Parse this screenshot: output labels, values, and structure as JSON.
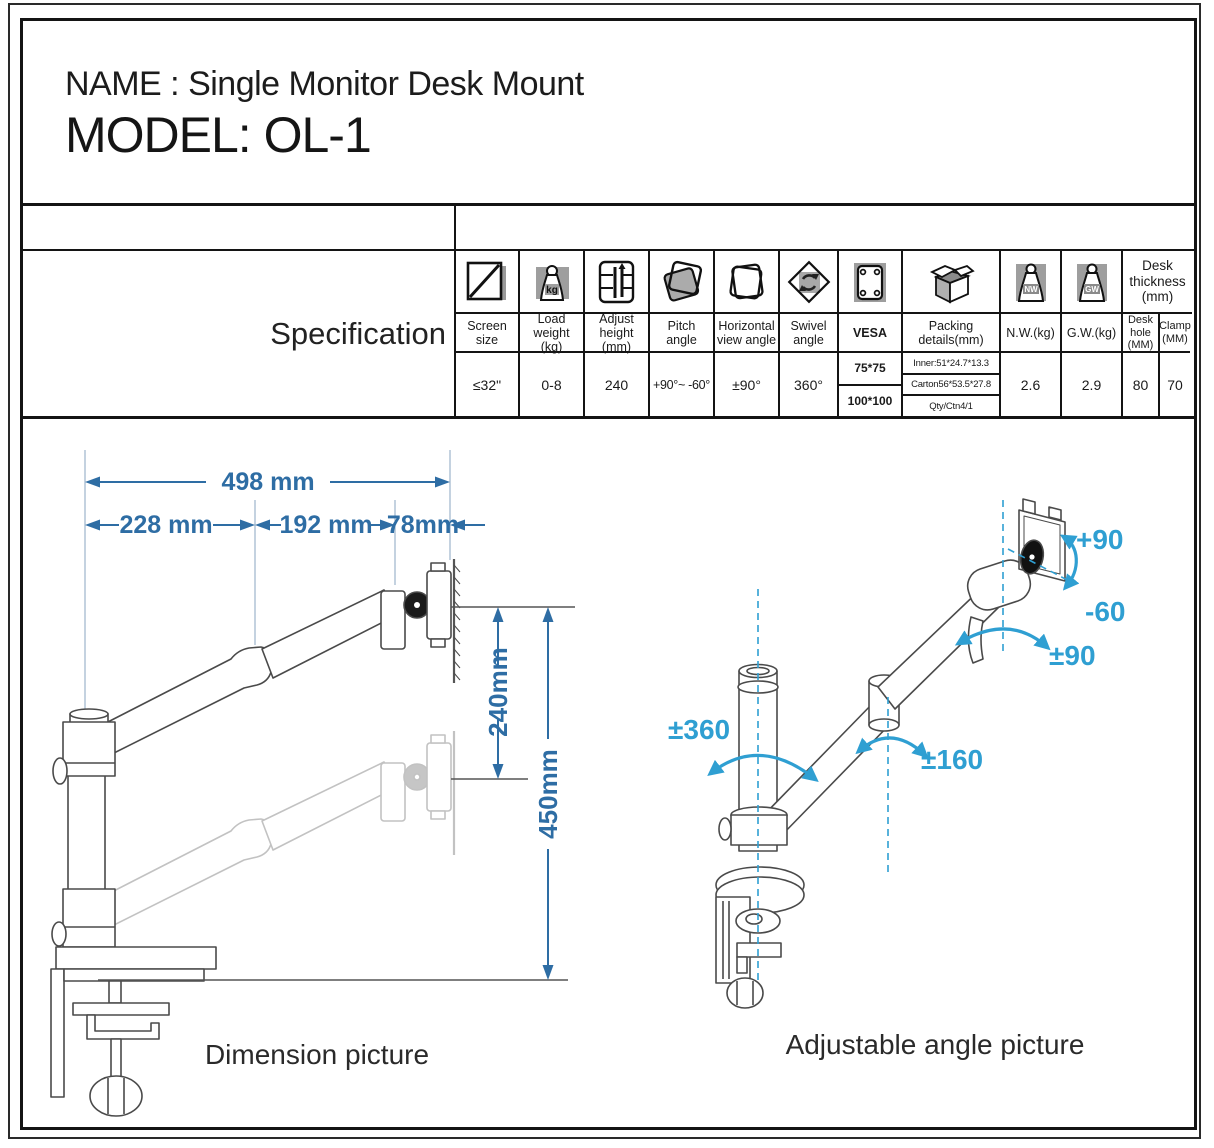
{
  "header": {
    "name_line": "NAME : Single Monitor Desk Mount",
    "model_line": "MODEL: OL-1"
  },
  "spec": {
    "section_label": "Specification",
    "icon_text": {
      "kg": "kg",
      "nw": "NW",
      "gw": "GW"
    },
    "desk_thickness_header": "Desk thickness (mm)",
    "columns": [
      {
        "icon": "screen-size-icon",
        "label": "Screen size",
        "value": "≤32\""
      },
      {
        "icon": "load-weight-icon",
        "label": "Load weight (kg)",
        "value": "0-8"
      },
      {
        "icon": "adjust-height-icon",
        "label": "Adjust height (mm)",
        "value": "240"
      },
      {
        "icon": "pitch-angle-icon",
        "label": "Pitch angle",
        "value": "+90°~ -60°"
      },
      {
        "icon": "horizontal-view-icon",
        "label": "Horizontal view angle",
        "value": "±90°"
      },
      {
        "icon": "swivel-angle-icon",
        "label": "Swivel angle",
        "value": "360°"
      },
      {
        "icon": "vesa-icon",
        "label": "VESA",
        "values": [
          "75*75",
          "100*100"
        ]
      },
      {
        "icon": "packing-box-icon",
        "label": "Packing details(mm)",
        "values": [
          "Inner:51*24.7*13.3",
          "Carton56*53.5*27.8",
          "Qty/Ctn4/1"
        ]
      },
      {
        "icon": "nw-weight-icon",
        "label": "N.W.(kg)",
        "value": "2.6"
      },
      {
        "icon": "gw-weight-icon",
        "label": "G.W.(kg)",
        "value": "2.9"
      },
      {
        "icon": "none",
        "label": "Desk hole (MM)",
        "value": "80"
      },
      {
        "icon": "none",
        "label": "Clamp (MM)",
        "value": "70"
      }
    ]
  },
  "dimension_diagram": {
    "caption": "Dimension picture",
    "accent_color": "#2e6da4",
    "dims": {
      "total_reach": "498 mm",
      "rear_arm": "228 mm",
      "front_arm": "192 mm",
      "head": "78mm",
      "height_range": "240mm",
      "pole_height": "450mm"
    }
  },
  "angle_diagram": {
    "caption": "Adjustable angle picture",
    "accent_color": "#2f9fd2",
    "labels": {
      "tilt_up": "+90",
      "tilt_down": "-60",
      "head_swivel": "±90",
      "base_rotation": "±360",
      "elbow_rotation": "±160"
    }
  }
}
